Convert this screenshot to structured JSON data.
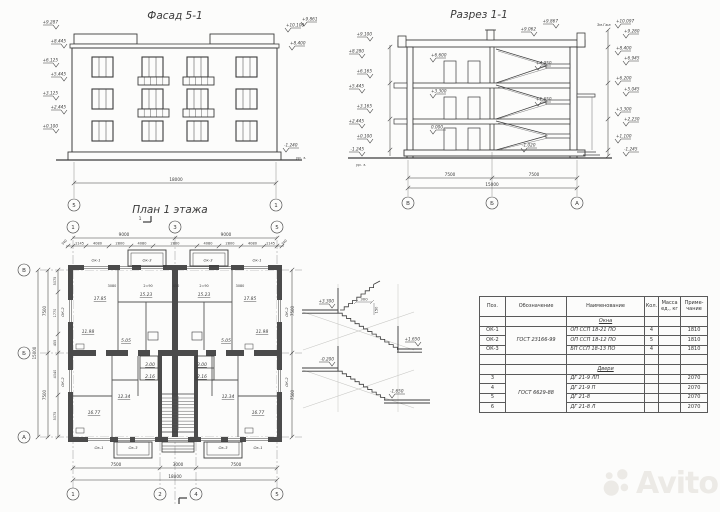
{
  "meta": {
    "watermark": "Avito"
  },
  "facade": {
    "title": "Фасад 5-1",
    "axes": [
      "5",
      "1"
    ],
    "dim_total": "18000",
    "elev_left": [
      "+9.287",
      "+8.445",
      "+6.125",
      "+5.445",
      "+3.125",
      "+2.445",
      "+0.100"
    ],
    "elev_right": [
      "+10.100",
      "+9.861",
      "+8.400"
    ],
    "elev_ground": "-1.240",
    "ground_label": "ур. з."
  },
  "section": {
    "title": "Разрез 1-1",
    "roof_note": "Зм.Гжа",
    "axes": [
      "В",
      "Б",
      "А"
    ],
    "dims_bottom": [
      "7500",
      "7500"
    ],
    "dim_total": "15000",
    "elev_roof": [
      "+9.867",
      "+9.062"
    ],
    "elev_left": [
      "+9.100",
      "+8.280",
      "+6.165",
      "+5.445",
      "+3.165",
      "+2.445",
      "+0.100",
      "-1.245"
    ],
    "elev_right": [
      "+10.097",
      "+9.280",
      "+8.400",
      "+6.945",
      "+6.200",
      "+5.045",
      "+3.300",
      "+2.230",
      "+1.100",
      "-1.245"
    ],
    "elev_inner": [
      "+6.600",
      "+4.950",
      "+3.300",
      "+1.650",
      "0.000",
      "-1.020"
    ],
    "ground_label": "ур. з."
  },
  "plan": {
    "title": "План 1 этажа",
    "cut_label": "1",
    "axes_top": [
      "1",
      "3",
      "5"
    ],
    "axes_bottom": [
      "1",
      "2",
      "4",
      "5"
    ],
    "axes_left": [
      "В",
      "Б",
      "А"
    ],
    "dims_top_major": [
      "9000",
      "9000"
    ],
    "dims_top_detail": [
      "1145",
      "4080",
      "2800",
      "4080",
      "2800",
      "4080",
      "2800",
      "4080",
      "1145"
    ],
    "dims_edge": [
      "340",
      "340"
    ],
    "dims_bottom": [
      "7500",
      "3000",
      "7500"
    ],
    "dim_total_bottom": "18000",
    "dims_left": [
      "7500",
      "7500"
    ],
    "dim_total_left": "15000",
    "dims_left_detail": [
      "5075",
      "1770",
      "455",
      "4040",
      "5075"
    ],
    "dims_right": [
      "7500",
      "7500"
    ],
    "window_tags_top": [
      "Ок-1",
      "Ок-3",
      "Ок-3",
      "Ок-1"
    ],
    "window_tags_bottom": [
      "Ок-1",
      "Ок-3",
      "Ок-3",
      "Ок-1"
    ],
    "window_tags_side": [
      "ОК-2",
      "ОК-2",
      "ОК-2",
      "ОК-2"
    ],
    "rooms": [
      "17.85",
      "15.23",
      "15.23",
      "17.85",
      "11.98",
      "5.05",
      "3.00",
      "2.16",
      "2.16",
      "3.00",
      "5.05",
      "11.98",
      "12.34",
      "16.77",
      "16.77",
      "12.34"
    ],
    "misc_labels": [
      "3080",
      "2=90",
      "450",
      "2=90",
      "3080"
    ]
  },
  "stair_detail": {
    "elevations": [
      "+3.300",
      "+1.650",
      "-0.200",
      "-1.650"
    ],
    "dims": [
      "300",
      "150"
    ]
  },
  "spec_table": {
    "col_headers": [
      "Поз.",
      "Обозначение",
      "Наименование",
      "Кол.",
      "Масса ед., кг",
      "Приме- чание"
    ],
    "windows_group": "Окна",
    "windows_gost": "ГОСТ 23166-99",
    "windows": [
      {
        "pos": "ОК-1",
        "name": "ОП ССП 18-21 ПО",
        "qty": "4",
        "note": "1810"
      },
      {
        "pos": "ОК-2",
        "name": "ОП ССП 18-12 ПО",
        "qty": "5",
        "note": "1810"
      },
      {
        "pos": "ОК-3",
        "name": "БП ССП 18-13 ПО",
        "qty": "4",
        "note": "1810"
      }
    ],
    "doors_group": "Двери",
    "doors_gost": "ГОСТ 6629-88",
    "doors": [
      {
        "pos": "3",
        "name": "ДГ 21-9 ЛП",
        "note": "2070"
      },
      {
        "pos": "4",
        "name": "ДГ 21-9 П",
        "note": "2070"
      },
      {
        "pos": "5",
        "name": "ДГ 21-8",
        "note": "2070"
      },
      {
        "pos": "6",
        "name": "ДГ 21-8 Л",
        "note": "2070"
      }
    ]
  }
}
